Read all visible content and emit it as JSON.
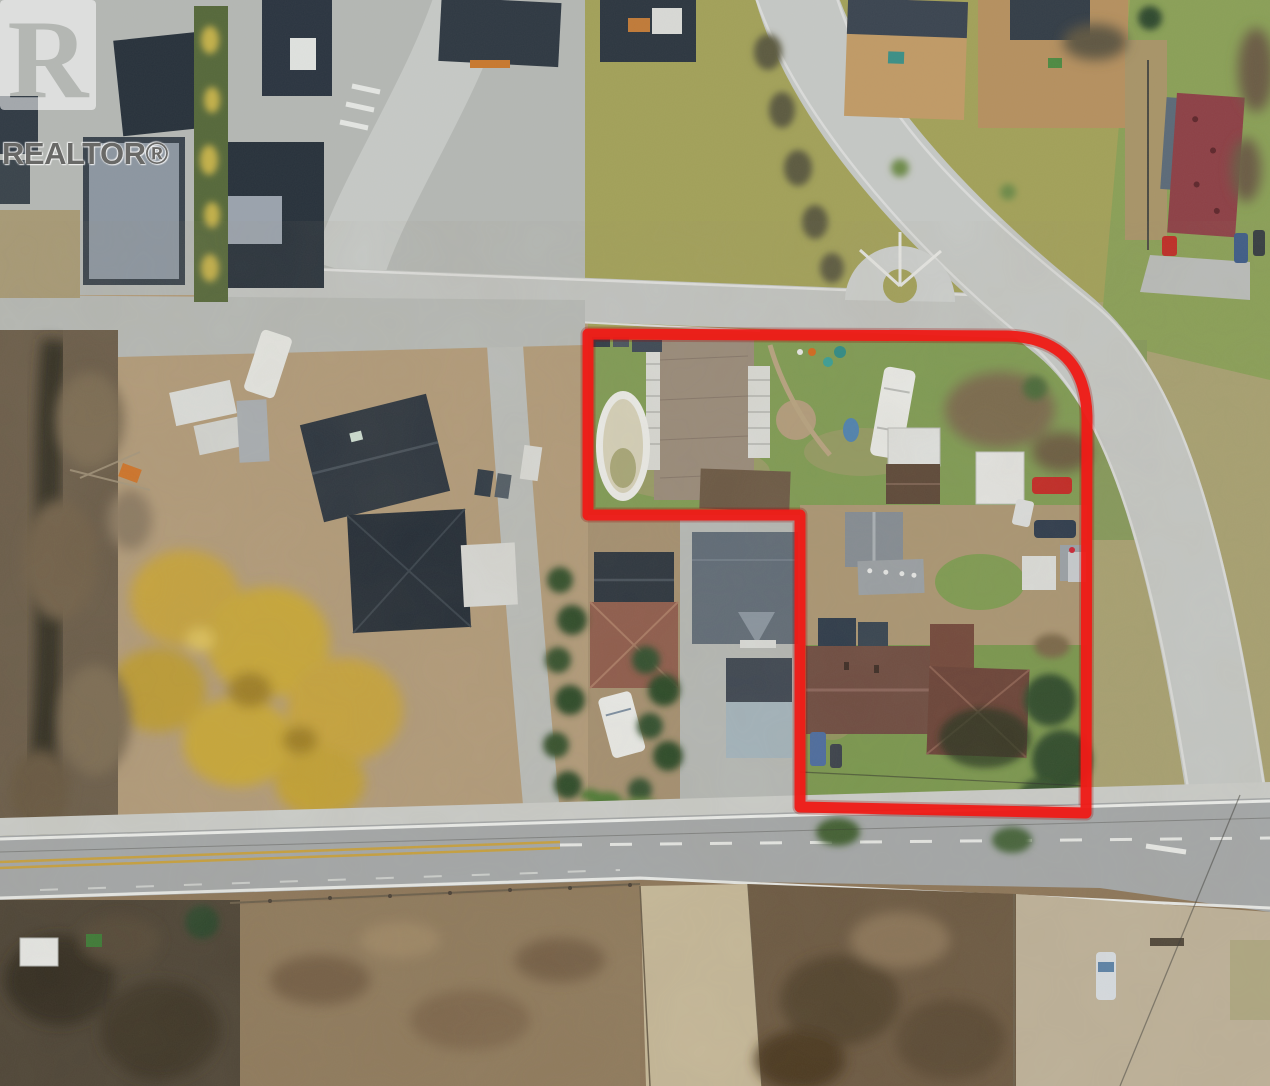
{
  "image": {
    "type": "aerial-drone-photograph",
    "description": "Overhead aerial view of a residential neighbourhood with a red outline marking an L-shaped property for sale; main road along the bottom, curved road on the right, modern development top-left, bare fields at the bottom.",
    "width": 1270,
    "height": 1086
  },
  "watermark": {
    "logo": "realtor-block-r-logo",
    "label": "REALTOR®"
  },
  "boundary": {
    "color": "#ef1b17",
    "stroke_width": 11,
    "path": "M588,334 L1008,336 Q1085,339 1087,416 L1086,813 L800,807 L800,515 L588,515 Z"
  },
  "palette": {
    "boundary_red": "#ef1b17",
    "concrete_road": "#c2c5c3",
    "asphalt_road": "#a4a8a9",
    "yellow_center_line": "#c8a13e",
    "white_line": "#e8eae8",
    "lawn_green": "#7e9a52",
    "dormant_grass": "#a5a158",
    "dirt_tan": "#b29b7a",
    "dark_scrub": "#6b5841",
    "gravel": "#beb29a",
    "charcoal_roof": "#27313b",
    "slate_roof": "#5f6b77",
    "shingle_roof": "#998b7a",
    "brown_roof": "#6e4b40",
    "terracotta_roof": "#8f5c4c",
    "maroon_roof": "#8d4046",
    "willow_yellow": "#c7a43c",
    "conifer_green": "#31502d",
    "pool_white": "#edeeea"
  }
}
